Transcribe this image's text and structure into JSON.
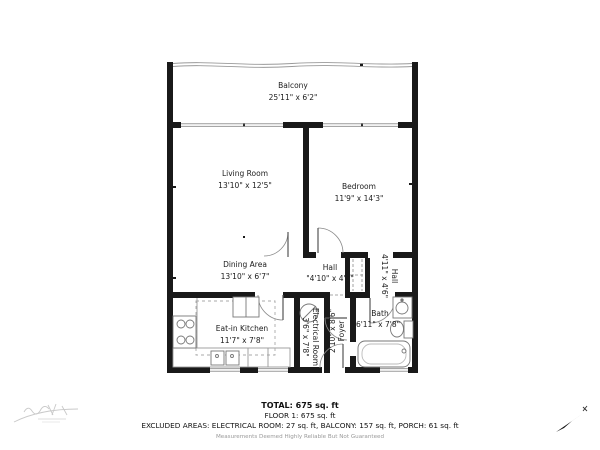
{
  "plan": {
    "rooms": {
      "balcony": {
        "name": "Balcony",
        "dims": "25'11\" x 6'2\""
      },
      "living_room": {
        "name": "Living Room",
        "dims": "13'10\" x 12'5\""
      },
      "bedroom": {
        "name": "Bedroom",
        "dims": "11'9\" x 14'3\""
      },
      "dining_area": {
        "name": "Dining Area",
        "dims": "13'10\" x 6'7\""
      },
      "hall": {
        "name": "Hall",
        "dims": "\"4'10\" x 4'5\""
      },
      "hall_right": {
        "name": "Hall",
        "dims": "4'11\" x 4'6\""
      },
      "kitchen": {
        "name": "Eat-in Kitchen",
        "dims": "11'7\" x 7'8\""
      },
      "electrical_room": {
        "name": "Electrical Room",
        "dims": "3'6\" x 7'8\""
      },
      "foyer": {
        "name": "Foyer",
        "dims": "2'10\" x 8'6\""
      },
      "bath": {
        "name": "Bath",
        "dims": "6'11\" x 7'8\""
      }
    },
    "icons": {
      "north_arrow": "north-arrow",
      "watermark": "watermark-logo"
    }
  },
  "summary": {
    "total": "TOTAL: 675 sq. ft",
    "floor": "FLOOR 1: 675 sq. ft",
    "excluded": "EXCLUDED AREAS: ELECTRICAL ROOM: 27 sq. ft, BALCONY: 157 sq. ft, PORCH: 61 sq. ft",
    "disclaimer": "Measurements Deemed Highly Reliable But Not Guaranteed"
  },
  "colors": {
    "wall": "#191919",
    "fixture": "#777777",
    "window": "#9a9a9a",
    "text": "#1c1c1c",
    "disclaimer_text": "#9a9a9a"
  }
}
